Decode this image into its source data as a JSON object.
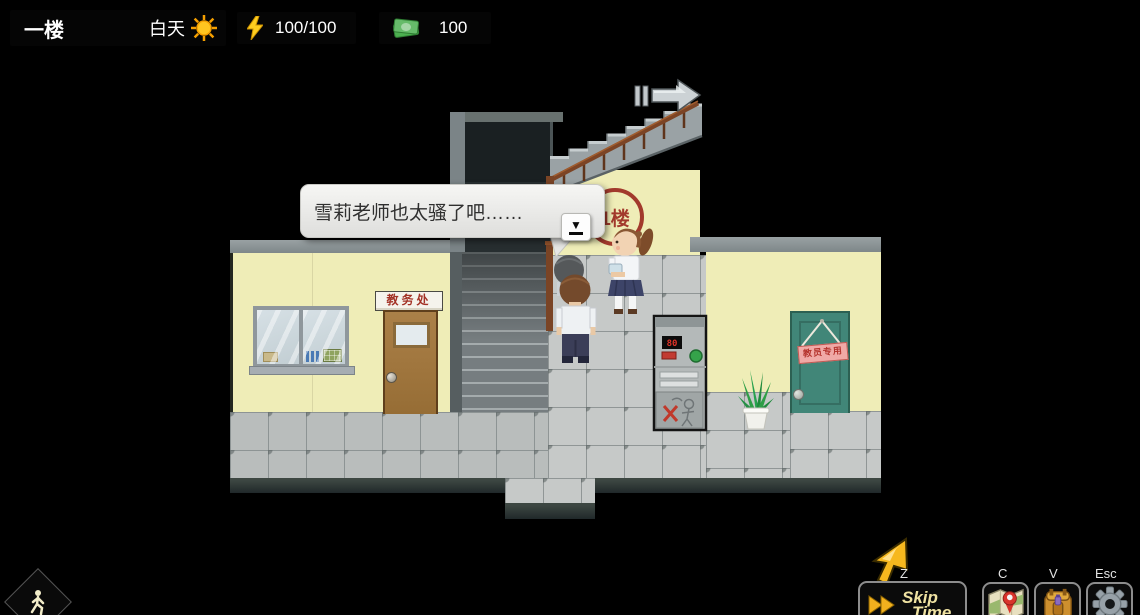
{
  "hud": {
    "location": "一楼",
    "time_of_day": "白天",
    "energy": "100/100",
    "money": "100"
  },
  "dialogue": {
    "text": "雪莉老师也太骚了吧……"
  },
  "scene": {
    "floor_sign": "1楼",
    "office_door_sign": "教务处",
    "staff_door_sign": "教员专用",
    "machine_display": "80"
  },
  "controls": {
    "skip_line1": "Skip",
    "skip_line2": "Time",
    "skip_hotkey": "Z",
    "map_hotkey": "C",
    "inventory_hotkey": "V",
    "settings_hotkey": "Esc"
  },
  "colors": {
    "accent_gold": "#f2b01e",
    "wall_yellow": "#efedb7",
    "teal_door": "#418678",
    "brown_door": "#a1763f",
    "sign_red": "#a23a2c"
  }
}
